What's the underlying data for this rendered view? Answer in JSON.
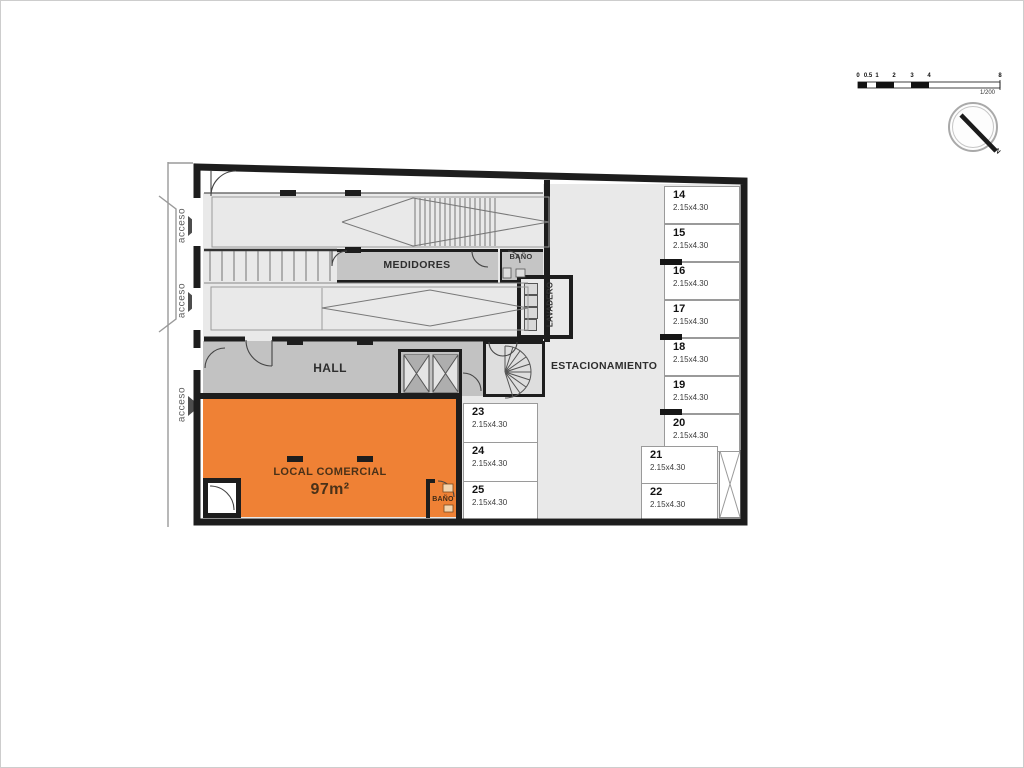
{
  "plan": {
    "access_labels": [
      "acceso",
      "acceso",
      "acceso"
    ],
    "rooms": {
      "medidores": "MEDIDORES",
      "banio_top": "BAÑO",
      "lavadero": "LAVADERO",
      "hall": "HALL",
      "estacionamiento": "ESTACIONAMIENTO",
      "local_comercial": "LOCAL COMERCIAL",
      "local_area": "97m²",
      "banio_local": "BAÑO"
    },
    "parking": {
      "right_column": [
        {
          "num": "14",
          "dim": "2.15x4.30"
        },
        {
          "num": "15",
          "dim": "2.15x4.30"
        },
        {
          "num": "16",
          "dim": "2.15x4.30"
        },
        {
          "num": "17",
          "dim": "2.15x4.30"
        },
        {
          "num": "18",
          "dim": "2.15x4.30"
        },
        {
          "num": "19",
          "dim": "2.15x4.30"
        },
        {
          "num": "20",
          "dim": "2.15x4.30"
        }
      ],
      "mid_column": [
        {
          "num": "23",
          "dim": "2.15x4.30"
        },
        {
          "num": "24",
          "dim": "2.15x4.30"
        },
        {
          "num": "25",
          "dim": "2.15x4.30"
        }
      ],
      "lower_right": [
        {
          "num": "21",
          "dim": "2.15x4.30"
        },
        {
          "num": "22",
          "dim": "2.15x4.30"
        }
      ]
    },
    "scale_bar": {
      "ticks": [
        "0",
        "0.5",
        "1",
        "2",
        "3",
        "4",
        "8"
      ],
      "ratio": "1/200"
    },
    "compass": {
      "north": "N"
    },
    "colors": {
      "orange": "#EF8135",
      "hall_gray": "#C2C2C2",
      "floor_gray": "#E9E9E9",
      "wall_black": "#1D1D1D"
    }
  }
}
